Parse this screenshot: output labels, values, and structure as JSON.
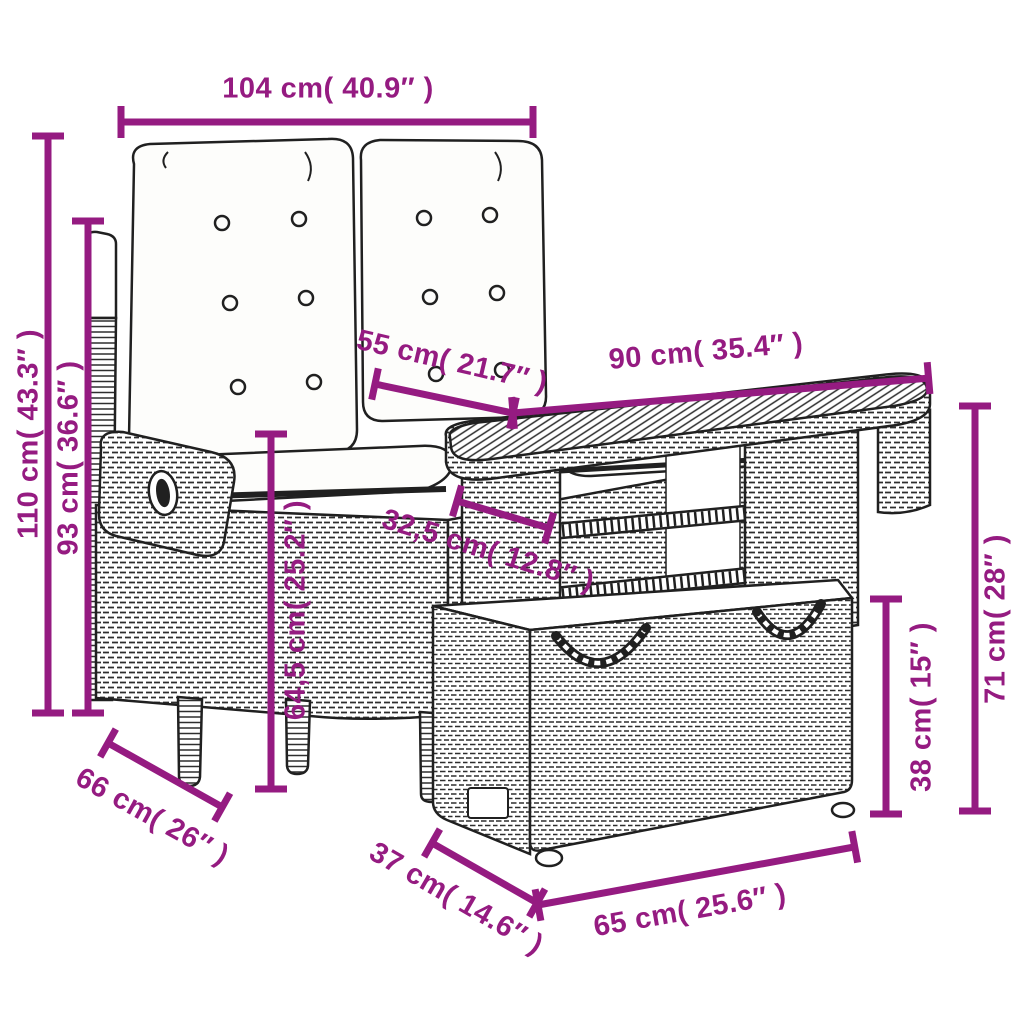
{
  "diagram": {
    "subject": "line drawing of a 2-seater reclining garden bench with tufted cushions, a slatted-top adjustable table and a rattan storage footrest",
    "colors": {
      "dimension_accent": "#951b81",
      "line_art": "#202020",
      "background": "#ffffff"
    },
    "dimensions": {
      "bench_width": {
        "label": "104 cm( 40.9″ )"
      },
      "bench_height": {
        "label": "110 cm( 43.3″ )"
      },
      "backrest_height": {
        "label": "93 cm( 36.6″ )"
      },
      "table_depth": {
        "label": "55 cm( 21.7″ )"
      },
      "table_width": {
        "label": "90 cm( 35.4″ )"
      },
      "leg_inset": {
        "label": "32,5 cm( 12.8″ )"
      },
      "seat_to_floor": {
        "label": "64,5 cm( 25.2″ )"
      },
      "table_height": {
        "label": "71 cm( 28″ )"
      },
      "ottoman_height": {
        "label": "38 cm( 15″ )"
      },
      "bench_depth": {
        "label": "66 cm( 26″ )"
      },
      "ottoman_depth": {
        "label": "37 cm( 14.6″ )"
      },
      "ottoman_width": {
        "label": "65 cm( 25.6″ )"
      }
    }
  }
}
